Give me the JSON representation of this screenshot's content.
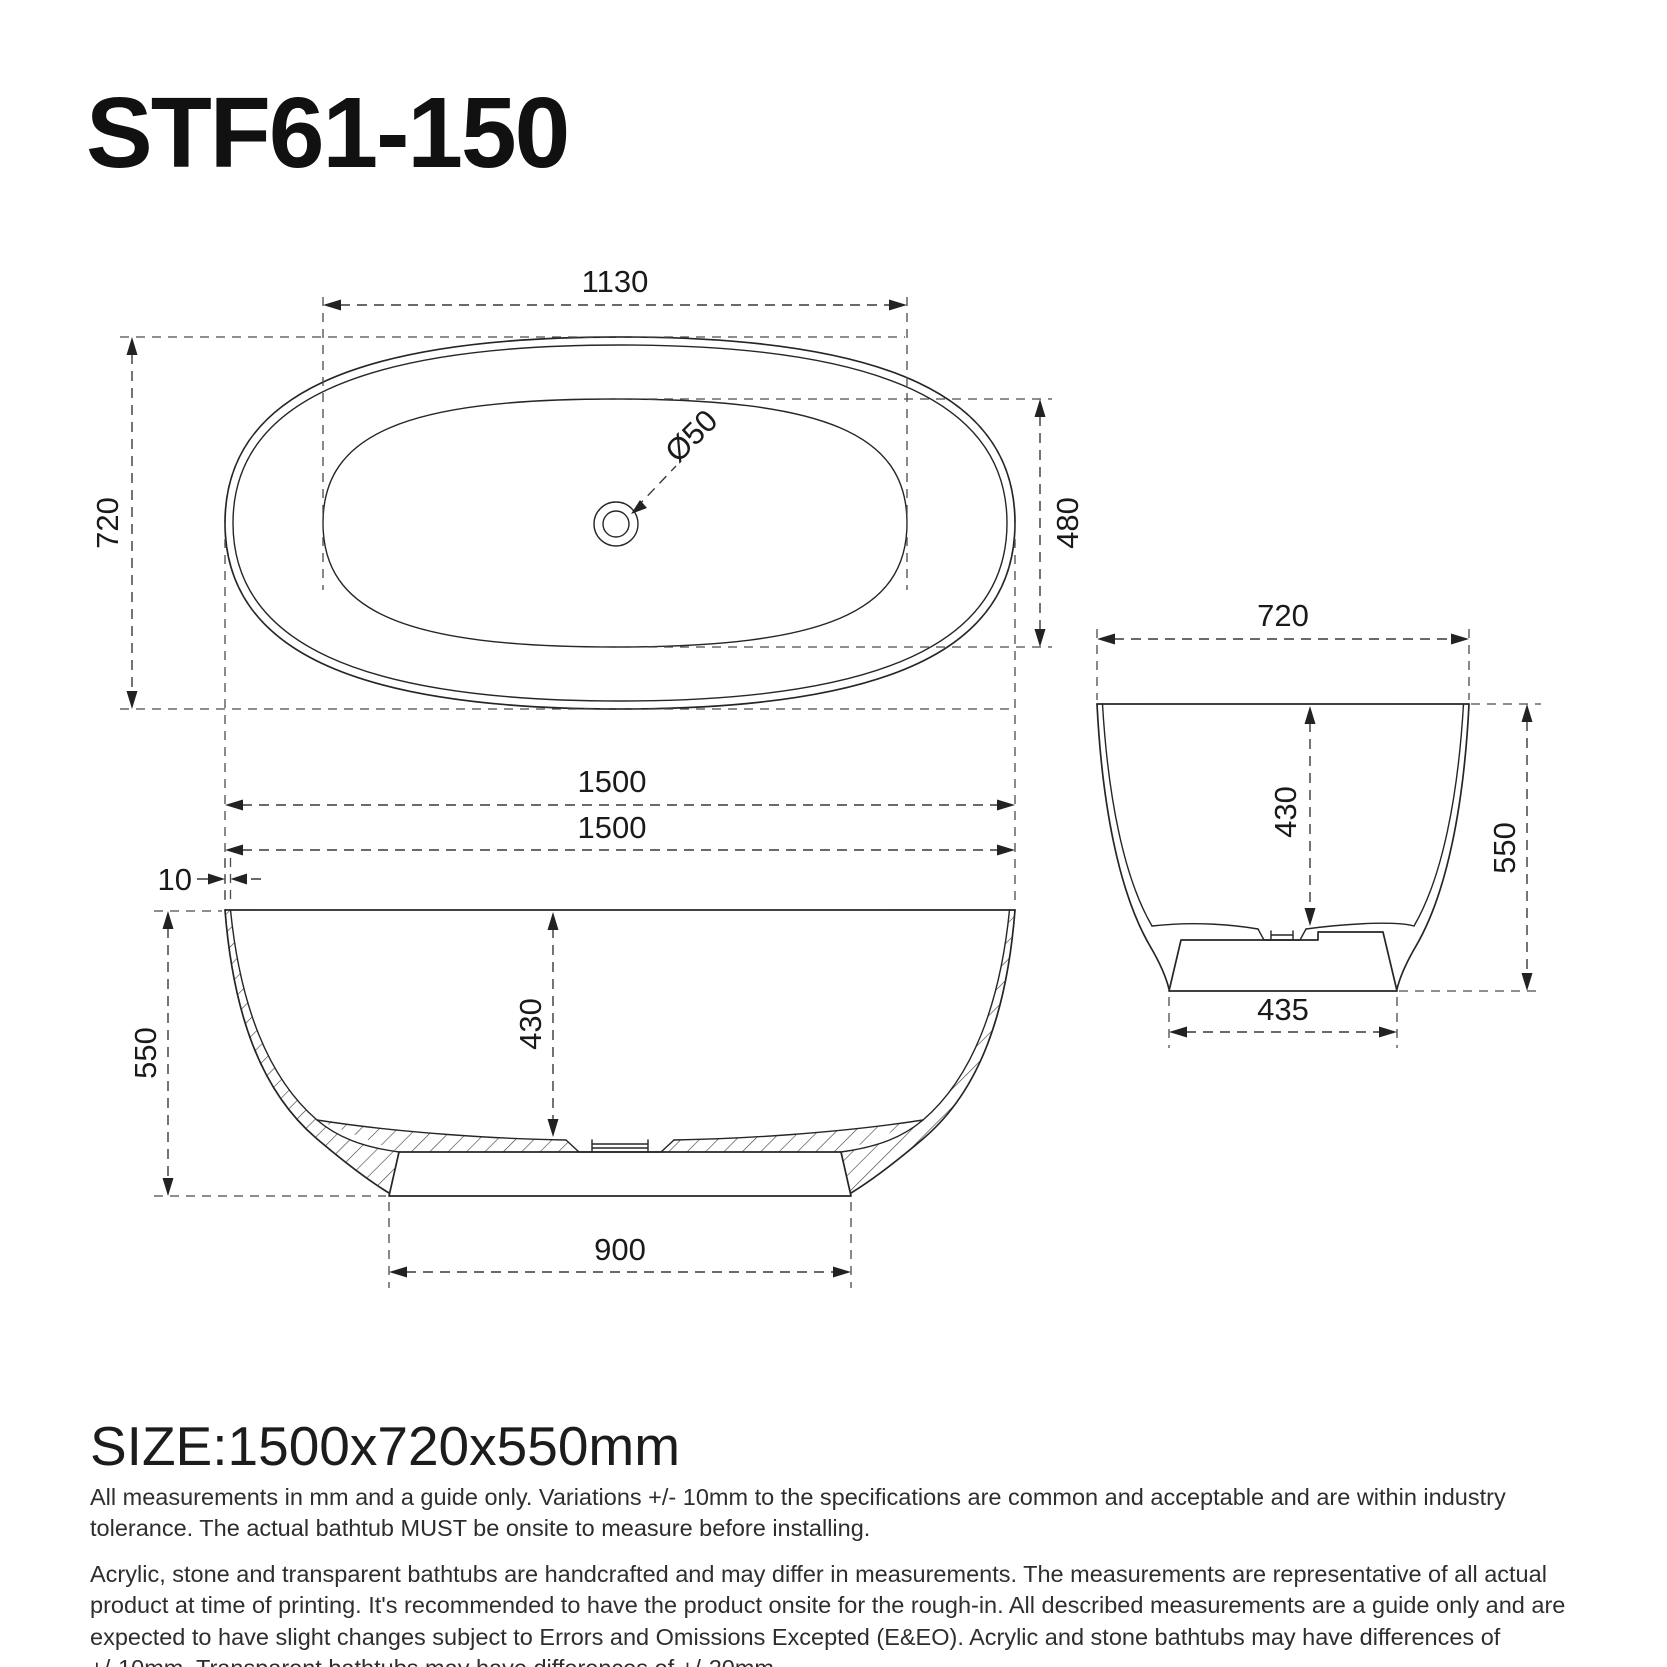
{
  "title": "STF61-150",
  "size_label": "SIZE:1500x720x550mm",
  "notes": [
    "All measurements in mm and a guide only. Variations +/- 10mm to the specifications are common and acceptable and are within industry tolerance. The actual bathtub MUST be onsite to measure before installing.",
    "Acrylic, stone and transparent bathtubs are handcrafted and may differ in measurements. The measurements are representative of all actual product at time of printing. It's recommended to have the product onsite for the rough-in. All described measurements are a guide only and are expected to have slight changes subject to Errors and Omissions Excepted (E&EO). Acrylic and stone bathtubs may have differences of +/-10mm. Transparent bathtubs may have differences of +/-20mm."
  ],
  "dims": {
    "top": {
      "inner_length": "1130",
      "overall_width": "720",
      "inner_width": "480",
      "drain_diameter": "Ø50",
      "overall_length": "1500"
    },
    "front": {
      "overall_length": "1500",
      "rim_thickness": "10",
      "overall_height": "550",
      "inner_depth": "430",
      "base_length": "900"
    },
    "side": {
      "overall_width": "720",
      "inner_depth": "430",
      "overall_height": "550",
      "base_width": "435"
    }
  },
  "colors": {
    "background": "#ffffff",
    "line": "#262626",
    "dimension_line": "#383838",
    "text": "#1a1a1a",
    "note_text": "#2e2e2e"
  }
}
